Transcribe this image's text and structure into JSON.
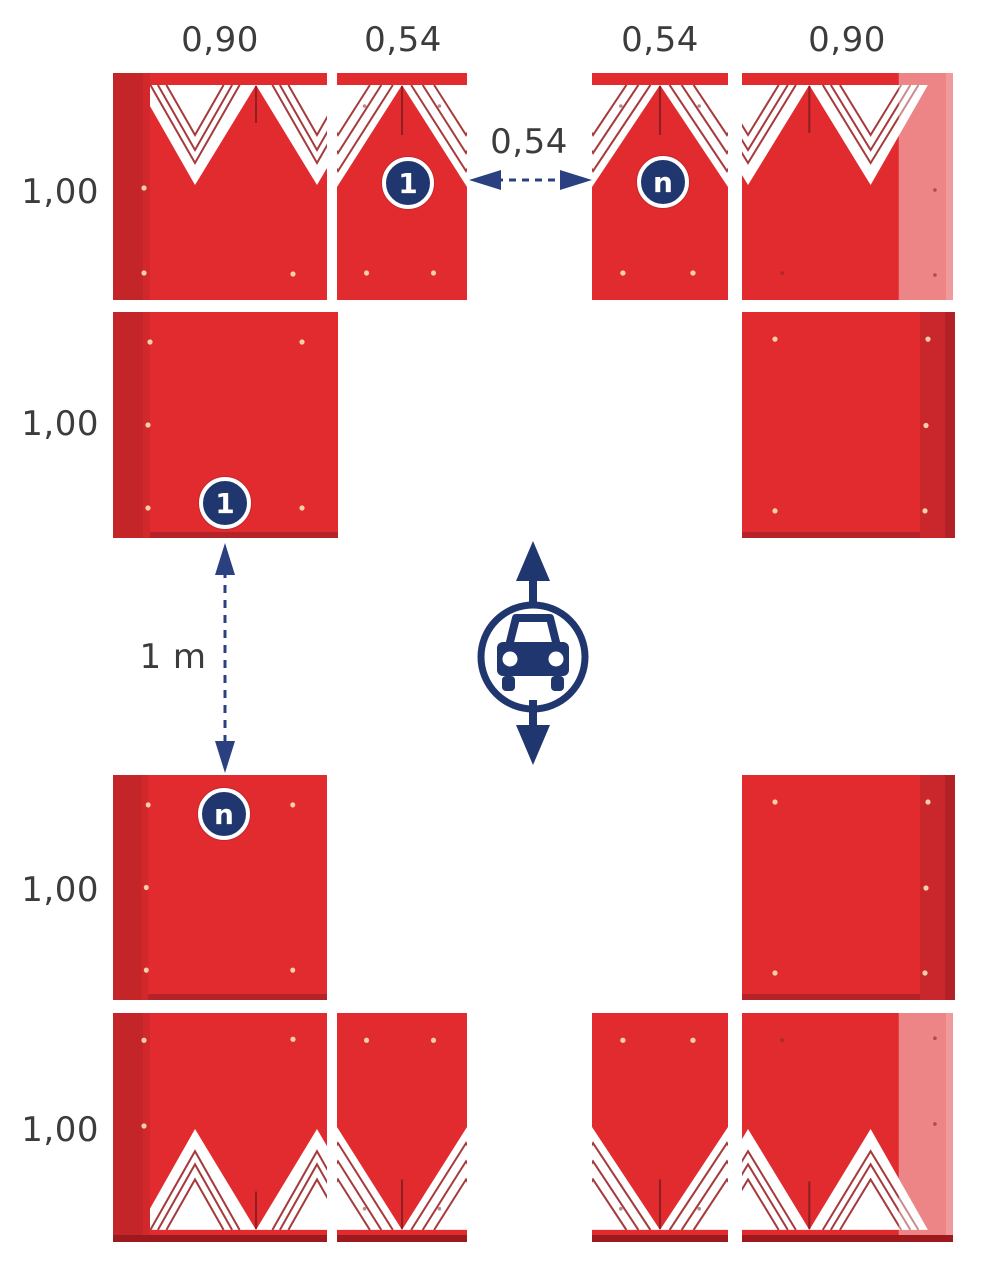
{
  "diagram": {
    "top_width_labels": [
      "0,90",
      "0,54",
      "0,54",
      "0,90"
    ],
    "side_height_labels": [
      "1,00",
      "1,00",
      "1,00",
      "1,00"
    ],
    "gap_width_label": "0,54",
    "row_spacing_label": "1 m",
    "markers": {
      "first": "1",
      "nth": "n"
    },
    "icons": {
      "vehicle": "car-in-circle-with-bidirectional-arrows",
      "dimension_arrows": "dashed-double-headed-arrows"
    },
    "colors": {
      "panel_red": "#E12B2F",
      "panel_fold_dark": "#C32529",
      "panel_fold_light_overlay": "#F2A0A3",
      "panel_base_strip": "#9C1A1E",
      "chevron_pinstripe": "#A63A3C",
      "accent_navy": "#20366F",
      "dimension_text": "#3C3C3C"
    }
  }
}
